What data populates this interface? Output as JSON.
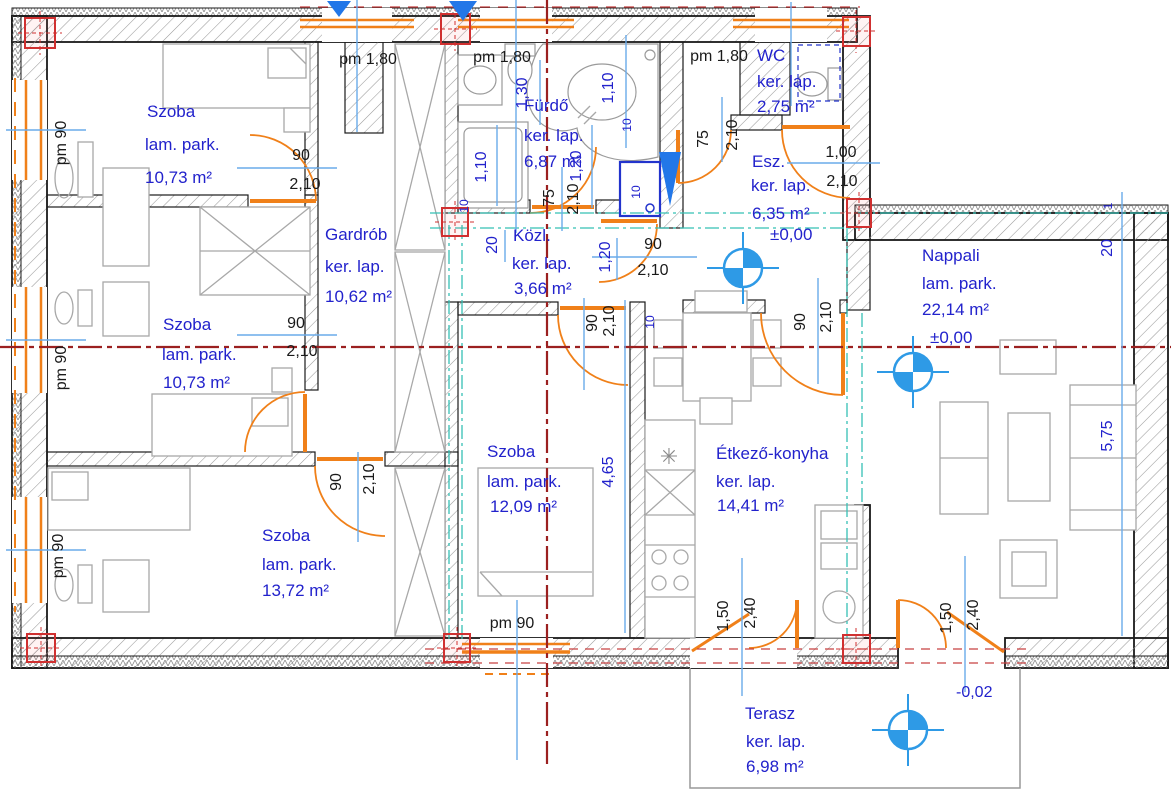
{
  "rooms": {
    "szoba1": {
      "name": "Szoba",
      "floor": "lam. park.",
      "area": "10,73 m²"
    },
    "gardrob": {
      "name": "Gardrób",
      "floor": "ker. lap.",
      "area": "10,62 m²"
    },
    "szoba2": {
      "name": "Szoba",
      "floor": "lam. park.",
      "area": "10,73 m²"
    },
    "szoba3": {
      "name": "Szoba",
      "floor": "lam. park.",
      "area": "13,72 m²"
    },
    "szoba4": {
      "name": "Szoba",
      "floor": "lam. park.",
      "area": "12,09 m²"
    },
    "furdo": {
      "name": "Fürdő",
      "floor": "ker. lap.",
      "area": "6,87 m²"
    },
    "kozl": {
      "name": "Közl.",
      "floor": "ker. lap.",
      "area": "3,66 m²"
    },
    "wc": {
      "name": "WC",
      "floor": "ker. lap.",
      "area": "2,75 m²"
    },
    "esz": {
      "name": "Esz.",
      "floor": "ker. lap.",
      "area": "6,35 m²",
      "level": "±0,00"
    },
    "nappali": {
      "name": "Nappali",
      "floor": "lam. park.",
      "area": "22,14 m²",
      "level": "±0,00"
    },
    "etkezo": {
      "name": "Étkező-konyha",
      "floor": "ker. lap.",
      "area": "14,41 m²"
    },
    "terasz": {
      "name": "Terasz",
      "floor": "ker. lap.",
      "area": "6,98 m²"
    }
  },
  "dims": {
    "pm180_a": "pm 1,80",
    "pm180_b": "pm 1,80",
    "pm180_c": "pm 1,80",
    "pm90_a": "pm 90",
    "pm90_b": "pm 90",
    "pm90_c": "pm 90",
    "pm90_d": "pm 90",
    "door1_w": "90",
    "door1_h": "2,10",
    "door2_w": "90",
    "door2_h": "2,10",
    "door3_w": "90",
    "door3_h": "2,10",
    "door4_w": "90",
    "door4_h": "2,10",
    "furdo_w": "75",
    "furdo_h": "2,10",
    "wc_w": "75",
    "wc_h": "2,10",
    "entry_w": "1,00",
    "entry_h": "2,10",
    "kozl_w": "90",
    "kozl_h": "2,10",
    "eszdoor_w": "90",
    "eszdoor_h": "2,10",
    "terasz1_w": "1,50",
    "terasz1_h": "2,40",
    "terasz2_w": "1,50",
    "terasz2_h": "2,40",
    "b130": "1,30",
    "b110a": "1,10",
    "b110b": "1,10",
    "b120": "1,20",
    "b120b": "1,20",
    "b20": "20",
    "b10a": "10",
    "b10b": "10",
    "b10c": "10",
    "b10d": "10",
    "b465": "4,65",
    "b575": "5,75",
    "tr20": "20",
    "tr1": "1",
    "terrace_level": "-0,02"
  },
  "colors": {
    "label_blue": "#2222cc",
    "dim_black": "#1a1a1a",
    "door_orange": "#f08019",
    "axis_red": "#9b2020",
    "beam_cyan": "#35c0b5",
    "dimline_blue": "#6aabea",
    "target_blue": "#2e9ae6",
    "marker_red": "#d03030",
    "fixture_blue": "#2233cc"
  }
}
